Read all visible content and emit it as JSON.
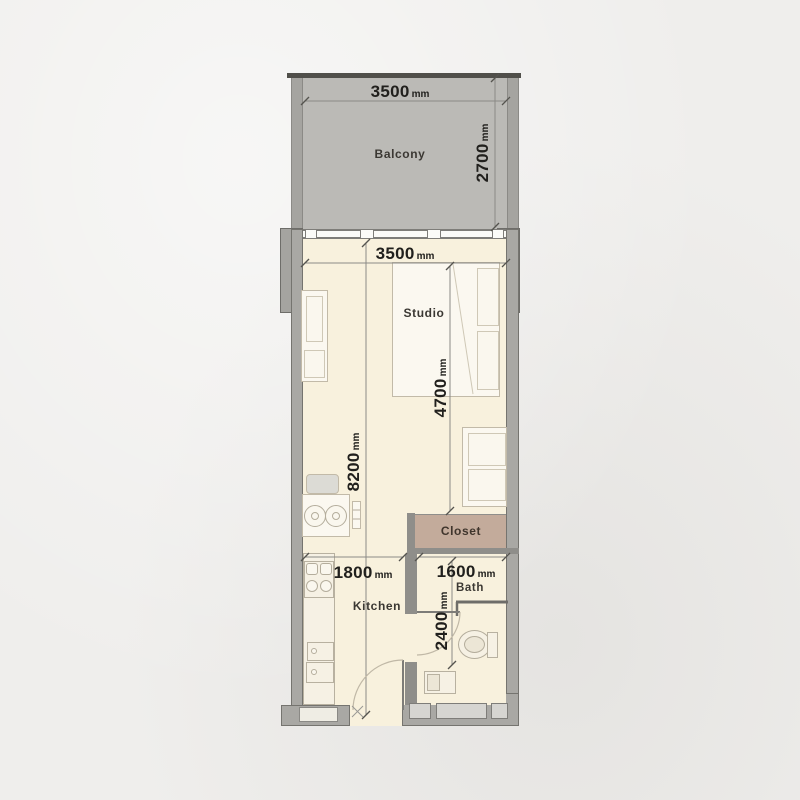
{
  "floorplan": {
    "rooms": {
      "balcony": "Balcony",
      "studio": "Studio",
      "kitchen": "Kitchen",
      "bath": "Bath",
      "closet": "Closet"
    },
    "dimensions": {
      "balcony_width": {
        "value": "3500",
        "unit": "mm"
      },
      "balcony_depth": {
        "value": "2700",
        "unit": "mm"
      },
      "studio_width": {
        "value": "3500",
        "unit": "mm"
      },
      "studio_length": {
        "value": "4700",
        "unit": "mm"
      },
      "overall_length": {
        "value": "8200",
        "unit": "mm"
      },
      "kitchen_width": {
        "value": "1800",
        "unit": "mm"
      },
      "bath_width": {
        "value": "1600",
        "unit": "mm"
      },
      "bath_depth": {
        "value": "2400",
        "unit": "mm"
      }
    },
    "colors": {
      "page_background": "#efeeec",
      "balcony_fill": "#bbbab6",
      "wall_fill": "#a9a8a4",
      "wall_edge": "#75746f",
      "floor_fill": "#f8f1dd",
      "closet_fill": "#c3ab9b",
      "furniture_outline": "#c2baa8",
      "dimension_text": "#21201d"
    }
  }
}
